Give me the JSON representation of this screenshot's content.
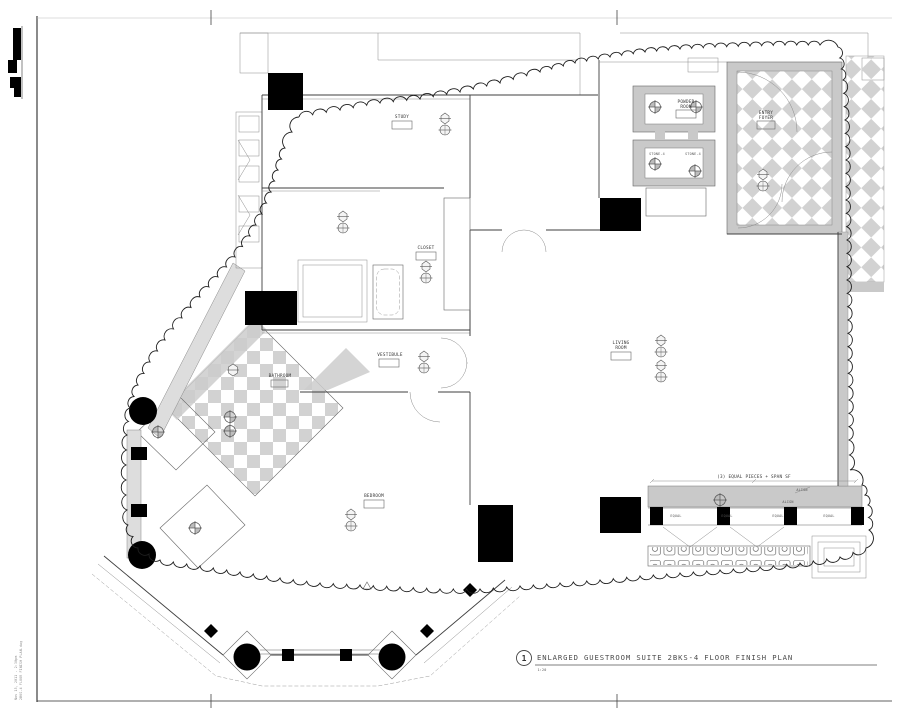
{
  "sheet": {
    "detail_number": "1",
    "detail_title": "ENLARGED GUESTROOM SUITE 2BKS-4 FLOOR FINISH PLAN",
    "detail_scale": "1:20",
    "plot_stamp_line1": "Nov 15, 2011 - 2:30pm",
    "plot_stamp_line2": "2BKS-4 FLOOR FINISH PLAN.dwg"
  },
  "rooms": {
    "study": "STUDY",
    "closet": "CLOSET",
    "vestibule": "VESTIBULE",
    "living_line1": "LIVING",
    "living_line2": "ROOM",
    "bedroom": "BEDROOM",
    "bathroom": "BATHROOM",
    "powder_line1": "POWDER",
    "powder_line2": "ROOM",
    "entry_line1": "ENTRY",
    "entry_line2": "FOYER",
    "stone_a": "STONE-4",
    "stone_b": "STONE-4"
  },
  "annotations": {
    "equal": "EQUAL",
    "align": "ALIGN",
    "pieces_note": "(3) EQUAL PIECES + SPAN SF"
  },
  "colors": {
    "paper": "#ffffff",
    "wall_line": "#3f3f3f",
    "tile_gray": "#c9c9c9",
    "checker_gray": "#d2d2d2",
    "poche_black": "#000000"
  }
}
